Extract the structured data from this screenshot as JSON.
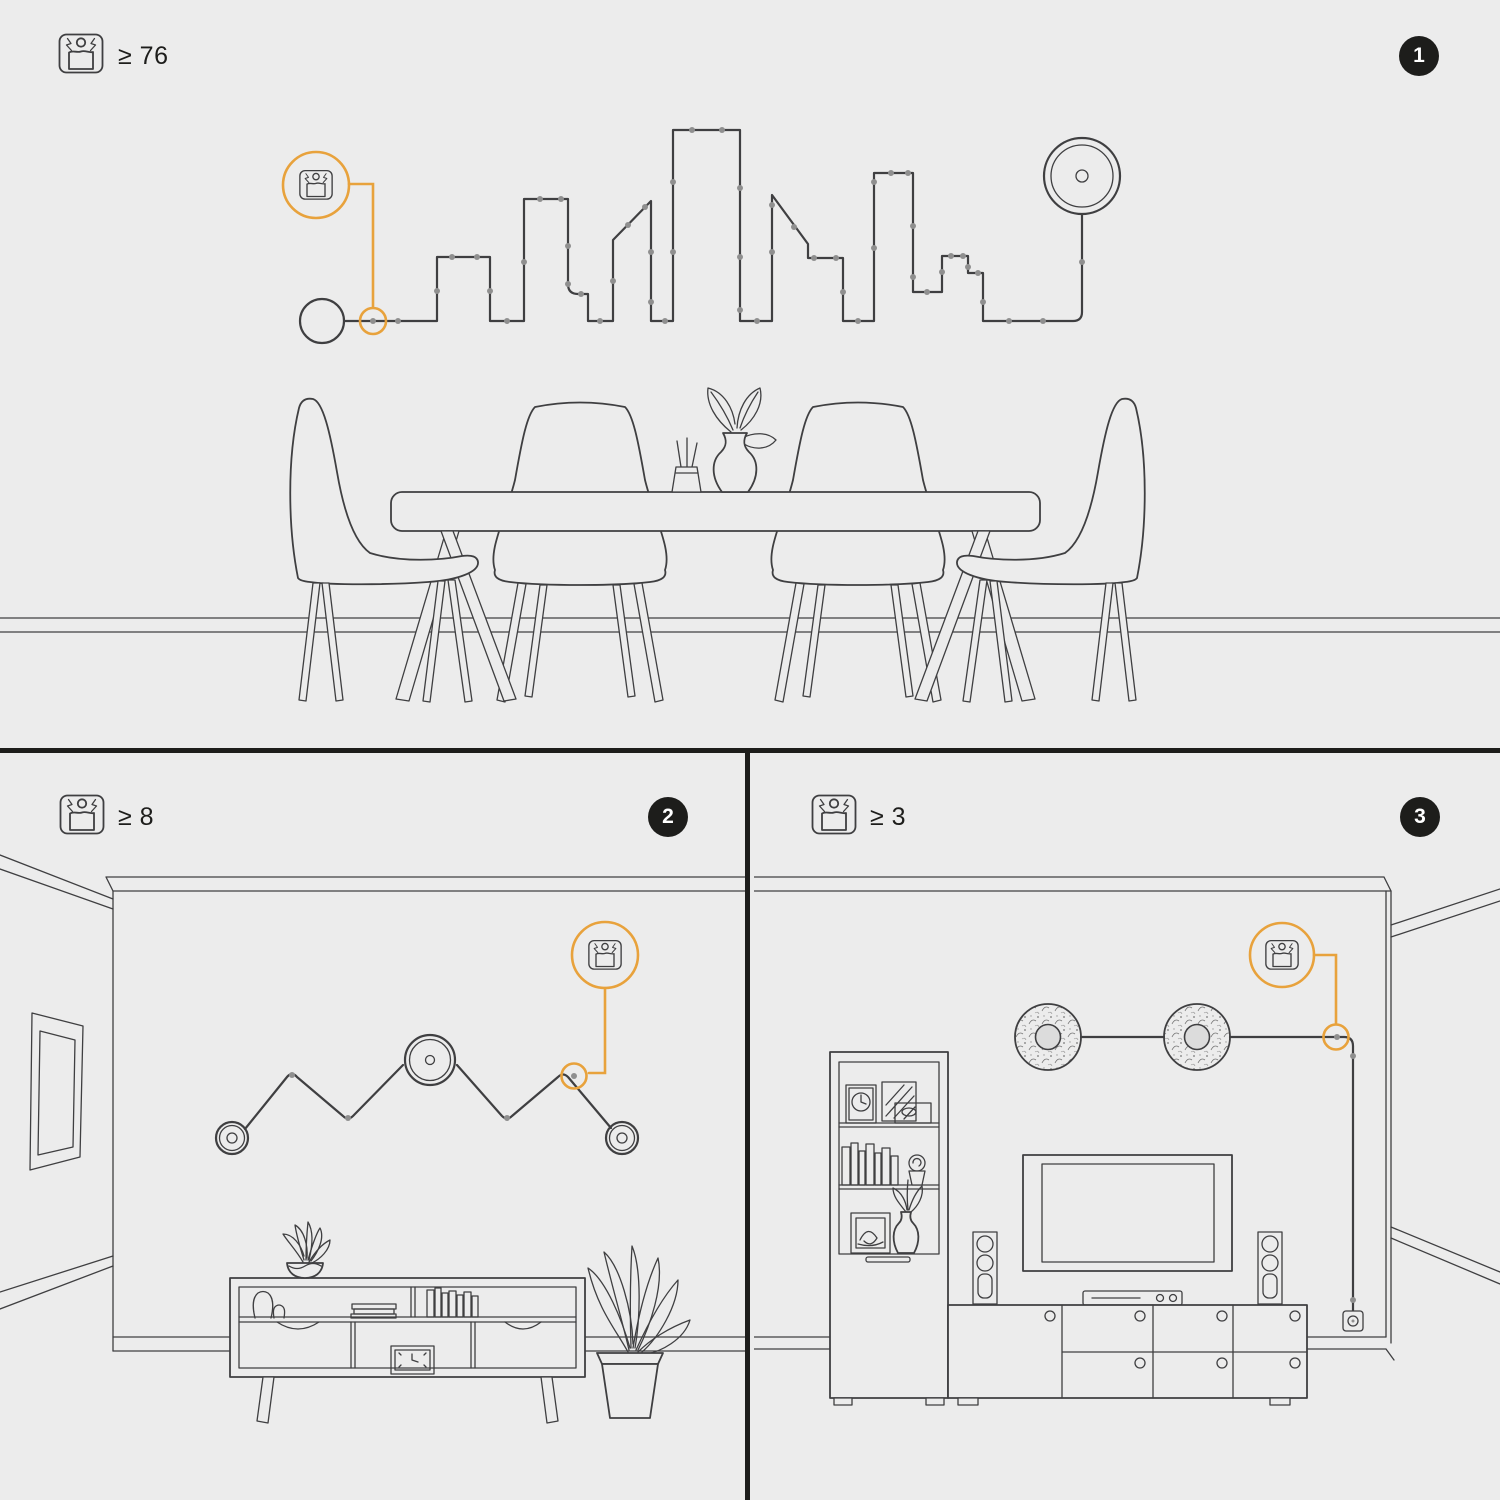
{
  "sheet": {
    "background_color": "#ececec",
    "line_color": "#3f3f41",
    "accent_color": "#e8a23c",
    "badge_color": "#1d1d1b",
    "badge_text_color": "#ffffff"
  },
  "panels": [
    {
      "badge": "1",
      "quantity_label": "≥ 76",
      "icon": "cable-clip-icon",
      "scene_name": "dining-room-city-skyline-cord-art"
    },
    {
      "badge": "2",
      "quantity_label": "≥ 8",
      "icon": "cable-clip-icon",
      "scene_name": "living-room-zigzag-cord-art"
    },
    {
      "badge": "3",
      "quantity_label": "≥ 3",
      "icon": "cable-clip-icon",
      "scene_name": "tv-room-cord-routing-to-outlet"
    }
  ]
}
